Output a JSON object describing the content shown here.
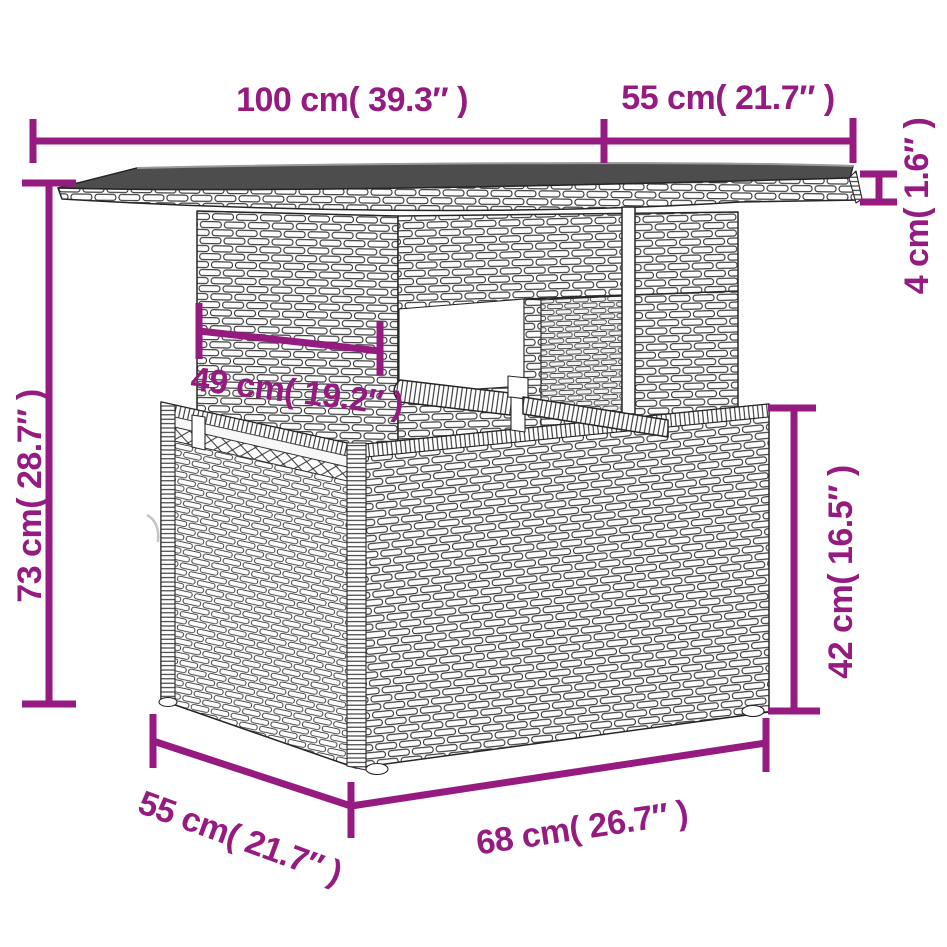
{
  "page": {
    "type": "product-dimension-diagram",
    "subject": "poly rattan garden table with glass top and storage base",
    "background": "#ffffff"
  },
  "colors": {
    "dimension_accent": "#951b81",
    "drawing_outline": "#262626",
    "glass_top": "#4d4d4d"
  },
  "dimensions": {
    "top_width": {
      "label": "100 cm( 39.3″ )",
      "cm": 100,
      "inches": 39.3
    },
    "top_depth": {
      "label": "55 cm( 21.7″ )",
      "cm": 55,
      "inches": 21.7
    },
    "top_thickness": {
      "label": "4 cm( 1.6″ )",
      "cm": 4,
      "inches": 1.6
    },
    "total_height": {
      "label": "73 cm( 28.7″ )",
      "cm": 73,
      "inches": 28.7
    },
    "pedestal_width": {
      "label": "49 cm( 19.2″ )",
      "cm": 49,
      "inches": 19.2
    },
    "base_height": {
      "label": "42 cm( 16.5″ )",
      "cm": 42,
      "inches": 16.5
    },
    "base_width": {
      "label": "68 cm( 26.7″ )",
      "cm": 68,
      "inches": 26.7
    },
    "base_depth": {
      "label": "55 cm( 21.7″ )",
      "cm": 55,
      "inches": 21.7
    }
  }
}
